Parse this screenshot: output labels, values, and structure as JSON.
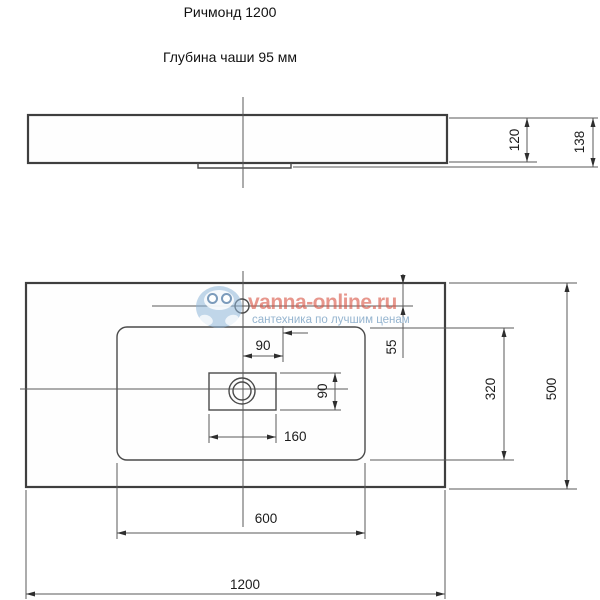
{
  "title": "Ричмонд 1200",
  "subtitle": "Глубина чаши 95 мм",
  "watermark": {
    "brand": "vanna-online.ru",
    "tagline": "сантехника по лучшим ценам",
    "brand_color": "#d95545",
    "logo_color": "#8cb4d7",
    "tagline_color": "#8fb0cc"
  },
  "drawing": {
    "line_color": "#4a4a4a",
    "side_view": {
      "basin_height": "120",
      "total_height": "138"
    },
    "top_view": {
      "hole_offset_width": "90",
      "edge_to_hole": "55",
      "drain_cutout_width": "160",
      "drain_cutout_height": "90",
      "bowl_depth": "320",
      "total_depth": "500",
      "bowl_width": "600",
      "total_width": "1200"
    }
  }
}
